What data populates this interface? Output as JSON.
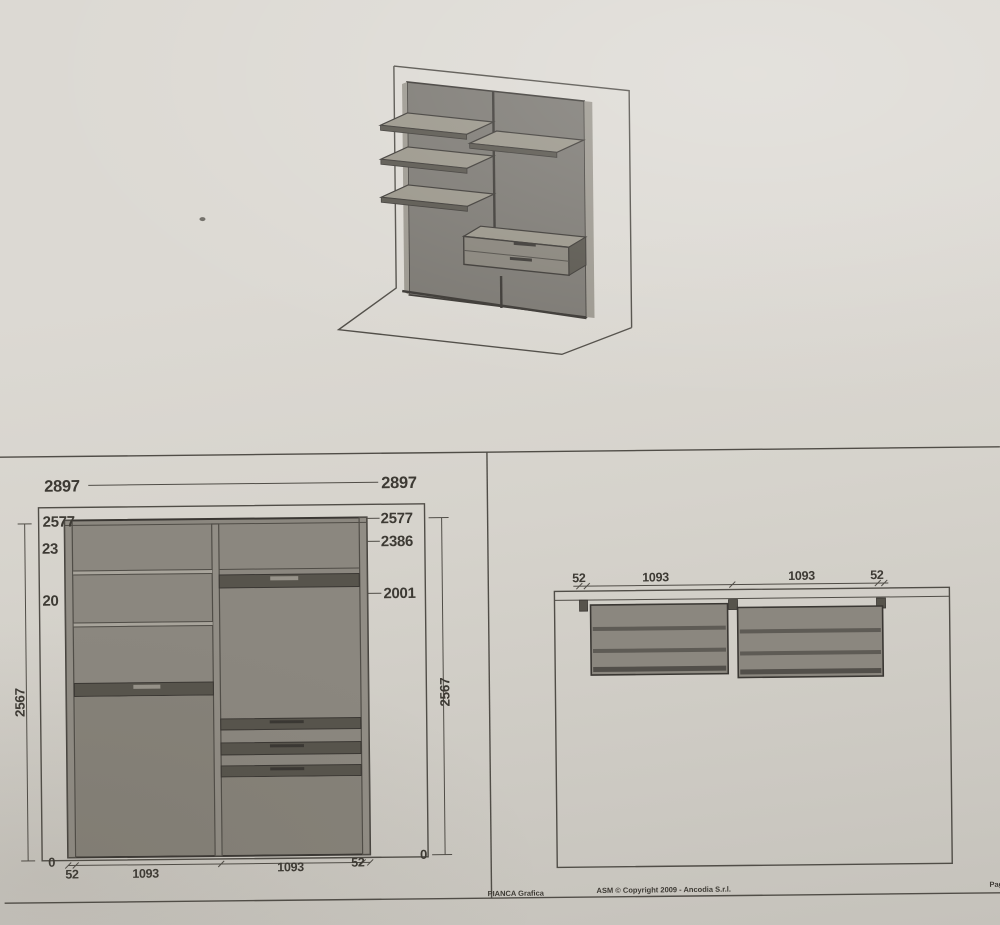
{
  "colors": {
    "paper_top": "#dcd9d3",
    "paper_mid": "#d6d3cc",
    "paper_bottom": "#cbc8c1",
    "paper_edge": "#c5c2bb",
    "line": "#504d47",
    "ink": "#3a3733",
    "text": "#3d3a34",
    "fill_mid": "#8b877f",
    "fill_side": "#918d85",
    "fill_lower": "#868279",
    "fill_dark": "#57544c",
    "fill_gap": "#a8a49b",
    "fill_light": "#97938a",
    "fill_iso": "#7a7771",
    "fill_iso_top": "#989488",
    "edge_light": "#9b978e"
  },
  "elevation": {
    "dim_width_left": "2897",
    "dim_width_right": "2897",
    "level_top_left": "2577",
    "level_mid_left": "23",
    "level_low_left": "20",
    "level_top_right": "2577",
    "level_mid_right": "2386",
    "level_low_right": "2001",
    "height_left": "2567",
    "height_right": "2567",
    "zero_left": "0",
    "zero_right": "0",
    "bottom_seg_1": "52",
    "bottom_seg_2": "1093",
    "bottom_seg_3": "1093",
    "bottom_seg_4": "52"
  },
  "plan": {
    "seg_1": "52",
    "seg_2": "1093",
    "seg_3": "1093",
    "seg_4": "52"
  },
  "footer": {
    "brand": "PIANCA Grafica",
    "copyright": "ASM © Copyright 2009 - Ancodia S.r.l.",
    "page": "Pag"
  }
}
